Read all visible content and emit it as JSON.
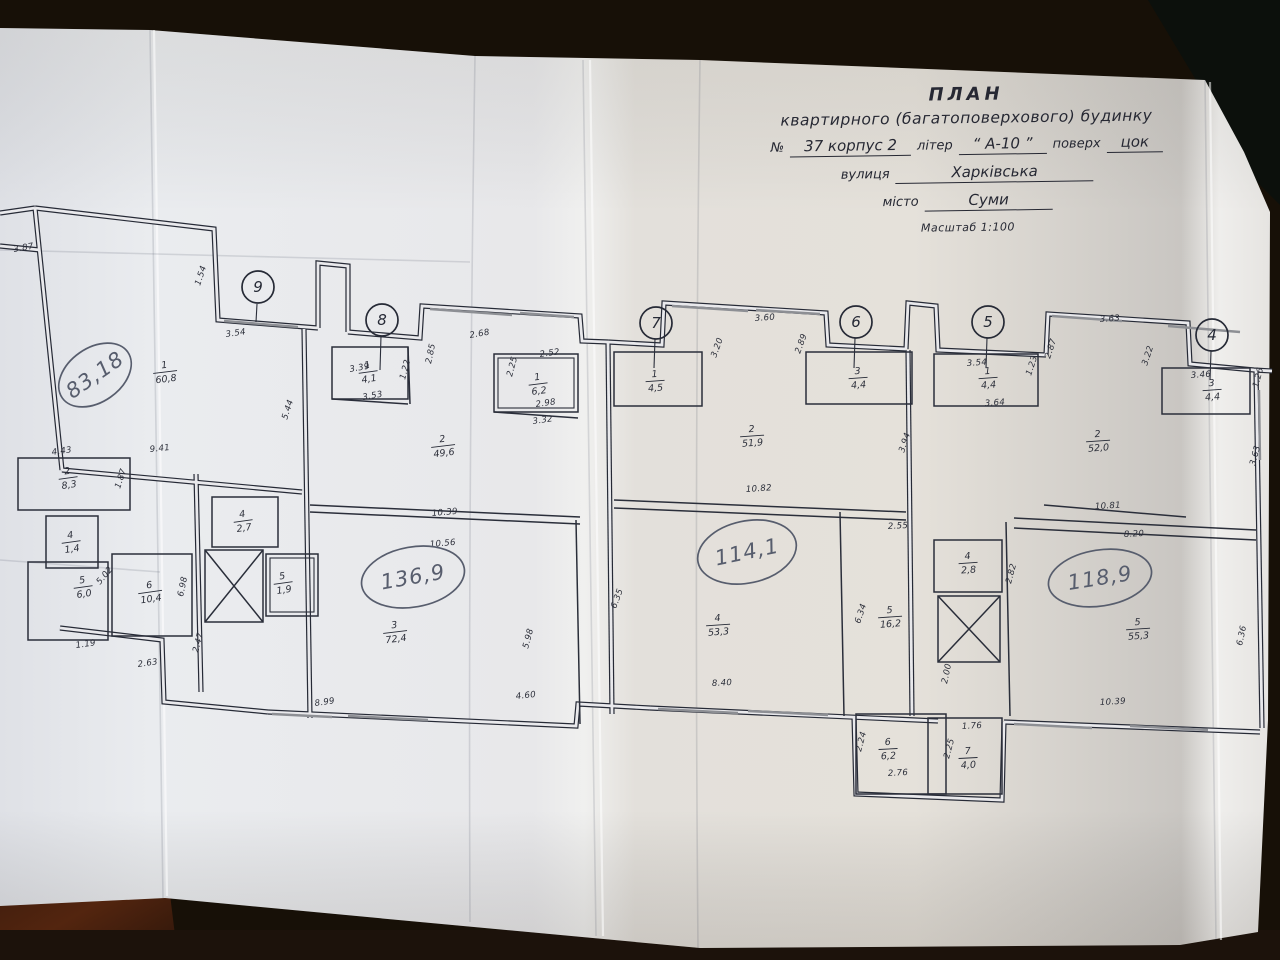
{
  "photo": {
    "table_color": "#171007",
    "paper_color": "#e9e9ec",
    "ink_color": "#262a36",
    "pen_color": "#575d6d",
    "wood_color": "#44200f"
  },
  "title_block": {
    "line1": "ПЛАН",
    "line2": "квартирного (багатоповерхового) будинку",
    "number_label": "№",
    "number_value": "37 корпус 2",
    "liter_label": "літер",
    "liter_value": "“ А-10 ”",
    "floor_label": "поверх",
    "floor_value": "цок",
    "street_label": "вулиця",
    "street_value": "Харківська",
    "city_label": "місто",
    "city_value": "Суми",
    "scale": "Масштаб 1:100"
  },
  "axes": [
    {
      "n": "9",
      "x": 258,
      "y": 287
    },
    {
      "n": "8",
      "x": 382,
      "y": 320
    },
    {
      "n": "7",
      "x": 656,
      "y": 323
    },
    {
      "n": "6",
      "x": 856,
      "y": 322
    },
    {
      "n": "5",
      "x": 988,
      "y": 322
    },
    {
      "n": "4",
      "x": 1212,
      "y": 335
    }
  ],
  "apartments": [
    {
      "total": "83,18",
      "x": 95,
      "y": 375,
      "rx": 40,
      "ry": 27,
      "rot": -35
    },
    {
      "total": "136,9",
      "x": 413,
      "y": 577,
      "rx": 52,
      "ry": 30,
      "rot": -10
    },
    {
      "total": "114,1",
      "x": 747,
      "y": 552,
      "rx": 50,
      "ry": 31,
      "rot": -12
    },
    {
      "total": "118,9",
      "x": 1100,
      "y": 578,
      "rx": 52,
      "ry": 28,
      "rot": -9
    }
  ],
  "rooms": [
    {
      "apt": "83,18",
      "n": "1",
      "area": "60,8",
      "x": 165,
      "y": 371,
      "r": -7
    },
    {
      "apt": "83,18",
      "n": "2",
      "area": "8,3",
      "x": 68,
      "y": 477,
      "r": -8
    },
    {
      "apt": "83,18",
      "n": "4",
      "area": "1,4",
      "x": 71,
      "y": 541,
      "r": -8
    },
    {
      "apt": "83,18",
      "n": "5",
      "area": "6,0",
      "x": 83,
      "y": 586,
      "r": -8
    },
    {
      "apt": "83,18",
      "n": "6",
      "area": "10,4",
      "x": 150,
      "y": 591,
      "r": -8
    },
    {
      "apt": "136,9",
      "n": "1",
      "area": "4,1",
      "x": 368,
      "y": 371,
      "r": -8
    },
    {
      "apt": "136,9",
      "n": "1",
      "area": "6,2",
      "x": 538,
      "y": 383,
      "r": -7
    },
    {
      "apt": "136,9",
      "n": "2",
      "area": "49,6",
      "x": 443,
      "y": 445,
      "r": -7
    },
    {
      "apt": "136,9",
      "n": "4",
      "area": "2,7",
      "x": 243,
      "y": 520,
      "r": -8
    },
    {
      "apt": "136,9",
      "n": "5",
      "area": "1,9",
      "x": 283,
      "y": 582,
      "r": -8
    },
    {
      "apt": "136,9",
      "n": "3",
      "area": "72,4",
      "x": 395,
      "y": 631,
      "r": -7
    },
    {
      "apt": "114,1",
      "n": "1",
      "area": "4,5",
      "x": 655,
      "y": 380,
      "r": -4
    },
    {
      "apt": "114,1",
      "n": "2",
      "area": "51,9",
      "x": 752,
      "y": 435,
      "r": -4
    },
    {
      "apt": "114,1",
      "n": "3",
      "area": "4,4",
      "x": 858,
      "y": 377,
      "r": -4
    },
    {
      "apt": "114,1",
      "n": "4",
      "area": "53,3",
      "x": 718,
      "y": 624,
      "r": -4
    },
    {
      "apt": "114,1",
      "n": "5",
      "area": "16,2",
      "x": 890,
      "y": 616,
      "r": -4
    },
    {
      "apt": "118,9",
      "n": "1",
      "area": "4,4",
      "x": 988,
      "y": 377,
      "r": -4
    },
    {
      "apt": "118,9",
      "n": "2",
      "area": "52,0",
      "x": 1098,
      "y": 440,
      "r": -4
    },
    {
      "apt": "118,9",
      "n": "3",
      "area": "4,4",
      "x": 1212,
      "y": 389,
      "r": -4
    },
    {
      "apt": "118,9",
      "n": "4",
      "area": "2,8",
      "x": 968,
      "y": 562,
      "r": -4
    },
    {
      "apt": "118,9",
      "n": "5",
      "area": "55,3",
      "x": 1138,
      "y": 628,
      "r": -4
    },
    {
      "apt": "118,9",
      "n": "6",
      "area": "6,2",
      "x": 888,
      "y": 748,
      "r": -3
    },
    {
      "apt": "118,9",
      "n": "7",
      "area": "4,0",
      "x": 968,
      "y": 757,
      "r": -3
    }
  ],
  "dimensions": [
    {
      "t": "3.87",
      "x": 14,
      "y": 252,
      "r": -10
    },
    {
      "t": "1.54",
      "x": 200,
      "y": 286,
      "r": -72
    },
    {
      "t": "3.54",
      "x": 226,
      "y": 337,
      "r": -8
    },
    {
      "t": "3.39",
      "x": 350,
      "y": 372,
      "r": -10
    },
    {
      "t": "3.53",
      "x": 363,
      "y": 400,
      "r": -10
    },
    {
      "t": "1.22",
      "x": 405,
      "y": 380,
      "r": -75
    },
    {
      "t": "2.85",
      "x": 431,
      "y": 364,
      "r": -78
    },
    {
      "t": "2.68",
      "x": 470,
      "y": 338,
      "r": -10
    },
    {
      "t": "2.52",
      "x": 540,
      "y": 357,
      "r": -8
    },
    {
      "t": "2.25",
      "x": 512,
      "y": 377,
      "r": -75
    },
    {
      "t": "2.98",
      "x": 536,
      "y": 407,
      "r": -8
    },
    {
      "t": "3.32",
      "x": 533,
      "y": 424,
      "r": -8
    },
    {
      "t": "5.44",
      "x": 287,
      "y": 420,
      "r": -72
    },
    {
      "t": "4.43",
      "x": 52,
      "y": 455,
      "r": -8
    },
    {
      "t": "9.41",
      "x": 150,
      "y": 452,
      "r": -6
    },
    {
      "t": "1.87",
      "x": 120,
      "y": 489,
      "r": -72
    },
    {
      "t": "5.02",
      "x": 100,
      "y": 585,
      "r": -50
    },
    {
      "t": "6.98",
      "x": 183,
      "y": 597,
      "r": -78
    },
    {
      "t": "2.47",
      "x": 198,
      "y": 653,
      "r": -75
    },
    {
      "t": "2.63",
      "x": 138,
      "y": 667,
      "r": -8
    },
    {
      "t": "1.19",
      "x": 76,
      "y": 648,
      "r": -8
    },
    {
      "t": "8.99",
      "x": 315,
      "y": 706,
      "r": -8
    },
    {
      "t": "4.60",
      "x": 516,
      "y": 699,
      "r": -6
    },
    {
      "t": "5.98",
      "x": 528,
      "y": 649,
      "r": -75
    },
    {
      "t": "10.39",
      "x": 432,
      "y": 516,
      "r": -5
    },
    {
      "t": "10.56",
      "x": 430,
      "y": 547,
      "r": -5
    },
    {
      "t": "3.20",
      "x": 716,
      "y": 358,
      "r": -70
    },
    {
      "t": "3.60",
      "x": 755,
      "y": 321,
      "r": -4
    },
    {
      "t": "2.89",
      "x": 800,
      "y": 354,
      "r": -70
    },
    {
      "t": "10.82",
      "x": 746,
      "y": 492,
      "r": -4
    },
    {
      "t": "3.94",
      "x": 904,
      "y": 453,
      "r": -72
    },
    {
      "t": "2.55",
      "x": 888,
      "y": 529,
      "r": -3
    },
    {
      "t": "6.35",
      "x": 616,
      "y": 609,
      "r": -70
    },
    {
      "t": "8.40",
      "x": 712,
      "y": 686,
      "r": -3
    },
    {
      "t": "6.34",
      "x": 860,
      "y": 624,
      "r": -72
    },
    {
      "t": "3.54",
      "x": 967,
      "y": 366,
      "r": -4
    },
    {
      "t": "3.64",
      "x": 985,
      "y": 406,
      "r": -4
    },
    {
      "t": "1.23",
      "x": 1031,
      "y": 376,
      "r": -72
    },
    {
      "t": "2.87",
      "x": 1050,
      "y": 359,
      "r": -72
    },
    {
      "t": "3.63",
      "x": 1100,
      "y": 322,
      "r": -4
    },
    {
      "t": "3.22",
      "x": 1147,
      "y": 366,
      "r": -72
    },
    {
      "t": "3.46",
      "x": 1191,
      "y": 378,
      "r": -4
    },
    {
      "t": "1.26",
      "x": 1258,
      "y": 388,
      "r": -75
    },
    {
      "t": "3.63",
      "x": 1255,
      "y": 466,
      "r": -75
    },
    {
      "t": "10.81",
      "x": 1095,
      "y": 509,
      "r": -3
    },
    {
      "t": "8.20",
      "x": 1124,
      "y": 537,
      "r": -3
    },
    {
      "t": "2.82",
      "x": 1011,
      "y": 584,
      "r": -75
    },
    {
      "t": "6.36",
      "x": 1242,
      "y": 646,
      "r": -78
    },
    {
      "t": "2.00",
      "x": 947,
      "y": 684,
      "r": -78
    },
    {
      "t": "10.39",
      "x": 1100,
      "y": 705,
      "r": -3
    },
    {
      "t": "2.24",
      "x": 861,
      "y": 752,
      "r": -75
    },
    {
      "t": "2.76",
      "x": 888,
      "y": 776,
      "r": -3
    },
    {
      "t": "1.76",
      "x": 962,
      "y": 729,
      "r": -3
    },
    {
      "t": "2.25",
      "x": 949,
      "y": 759,
      "r": -75
    }
  ]
}
